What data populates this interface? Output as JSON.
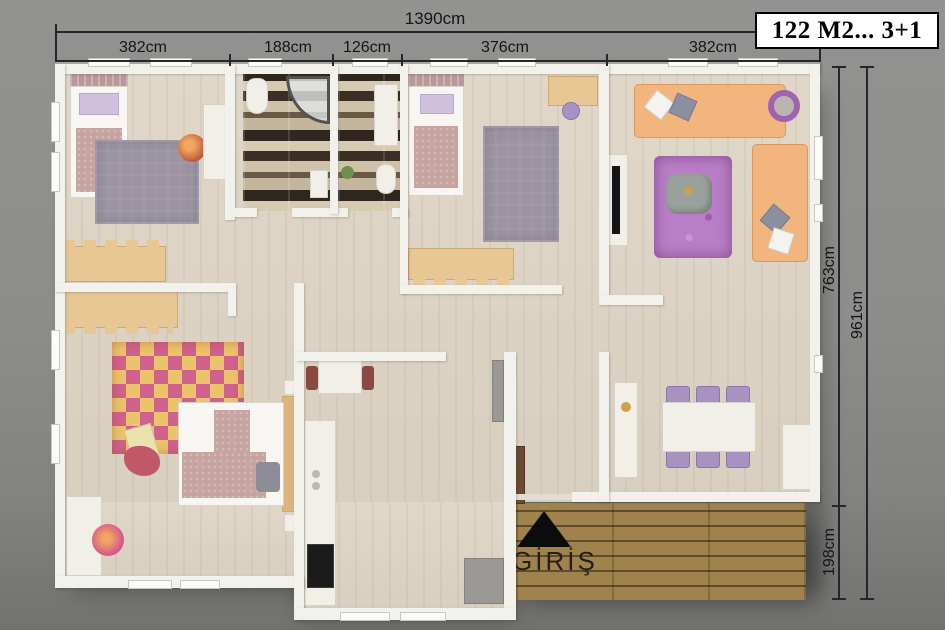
{
  "title_box": {
    "label": "122 M2... 3+1"
  },
  "dimensions": {
    "top": {
      "total": "1390cm",
      "segments": [
        "382cm",
        "188cm",
        "126cm",
        "376cm",
        "382cm"
      ]
    },
    "right": {
      "upper": "763cm",
      "lower": "198cm",
      "total": "961cm"
    }
  },
  "entrance": {
    "label": "GİRİŞ",
    "icon": "black-triangle-up"
  },
  "colors": {
    "background": "#8c8c8a",
    "wall": "#f3f1eb",
    "floor_wood": "#dcd3c4",
    "deck_wood": "#9d8049",
    "dimension_line": "#262626",
    "title_text": "#000000",
    "sofa_orange": "#f2b57e",
    "rug_purple": "#b87fc6",
    "rug_gray": "#9c94a2",
    "rug_checker_pink": "#d0608c",
    "rug_checker_yellow": "#eac36b",
    "bath_tile_dark": "#3b2f25",
    "bath_tile_light": "#cfc2a8"
  }
}
